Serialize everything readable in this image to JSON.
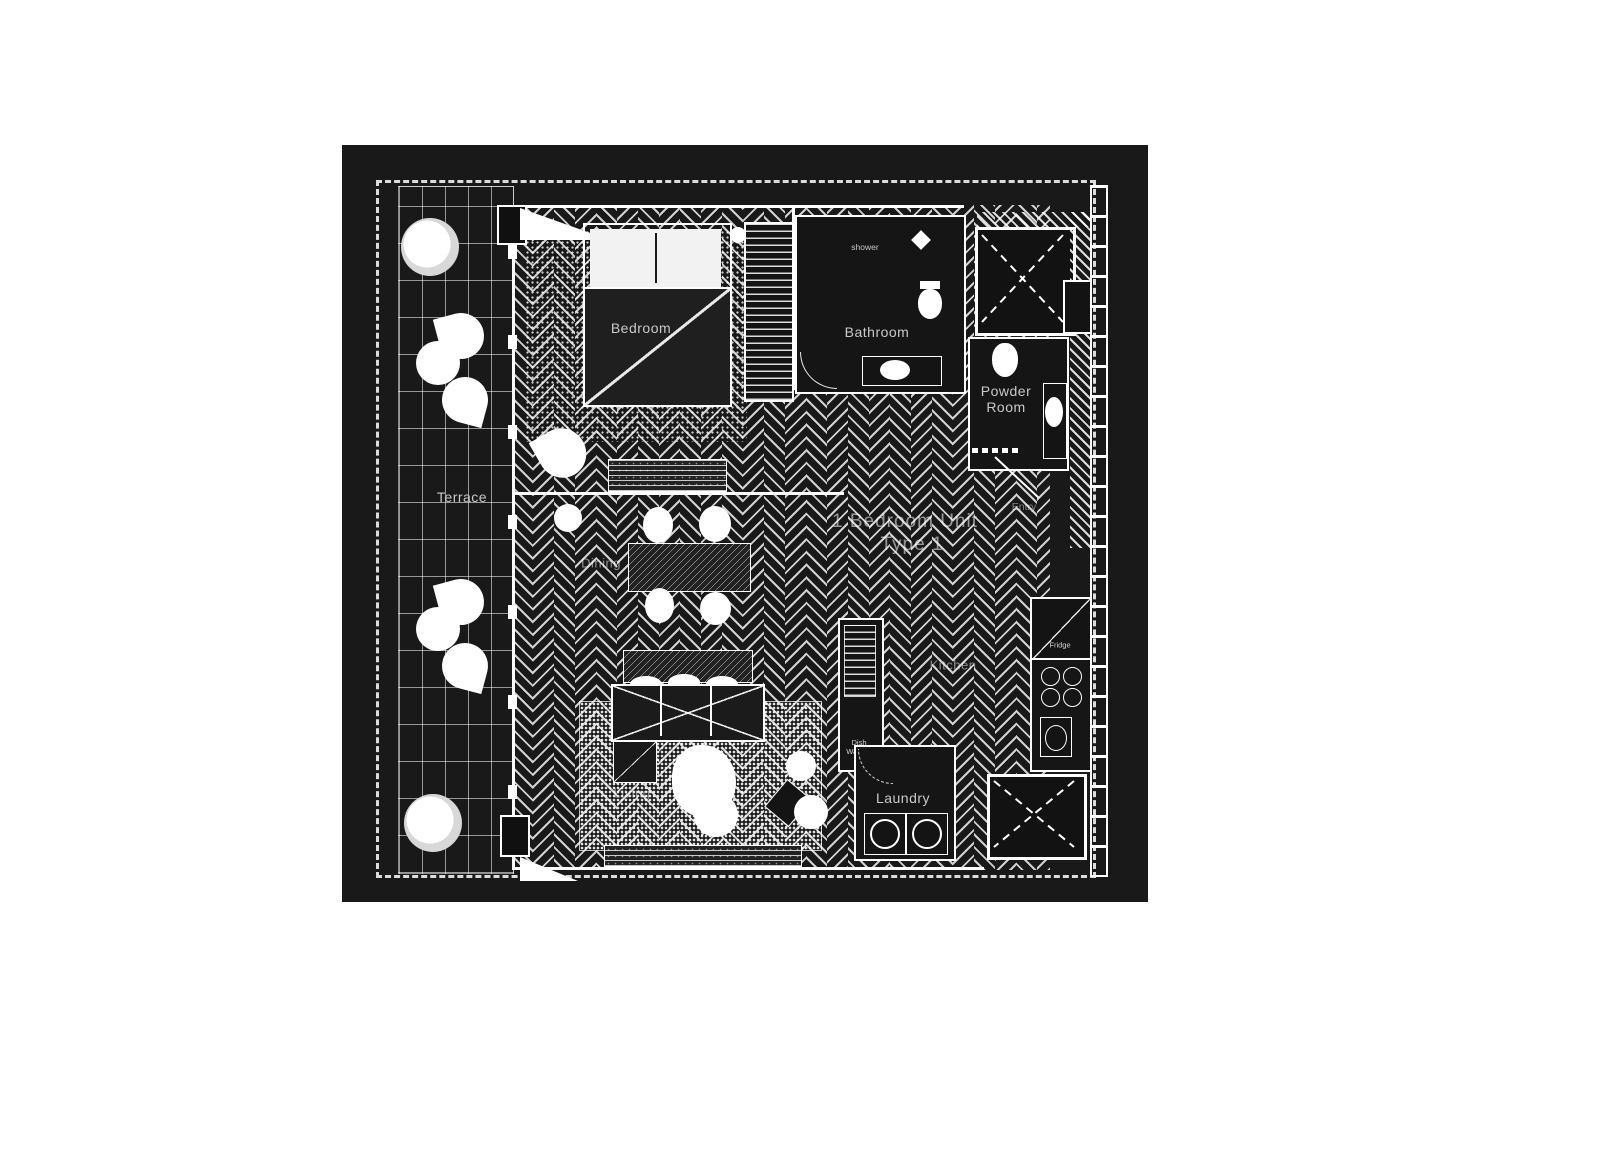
{
  "plan": {
    "unit_title": {
      "line1": "1 Bedroom Unit",
      "line2": "Type 1"
    },
    "rooms": {
      "terrace": "Terrace",
      "bedroom": "Bedroom",
      "bathroom": "Bathroom",
      "powder_line1": "Powder",
      "powder_line2": "Room",
      "entry": "Entry",
      "dining": "Dining",
      "living": "Living",
      "kitchen": "Kitchen",
      "laundry": "Laundry"
    },
    "fixtures": {
      "shower": "shower",
      "fridge": "Fridge",
      "dishwasher_line1": "Dish",
      "dishwasher_line2": "Washer"
    },
    "colors": {
      "page_background": "#ffffff",
      "plan_background": "#191919",
      "line": "#ffffff"
    }
  }
}
